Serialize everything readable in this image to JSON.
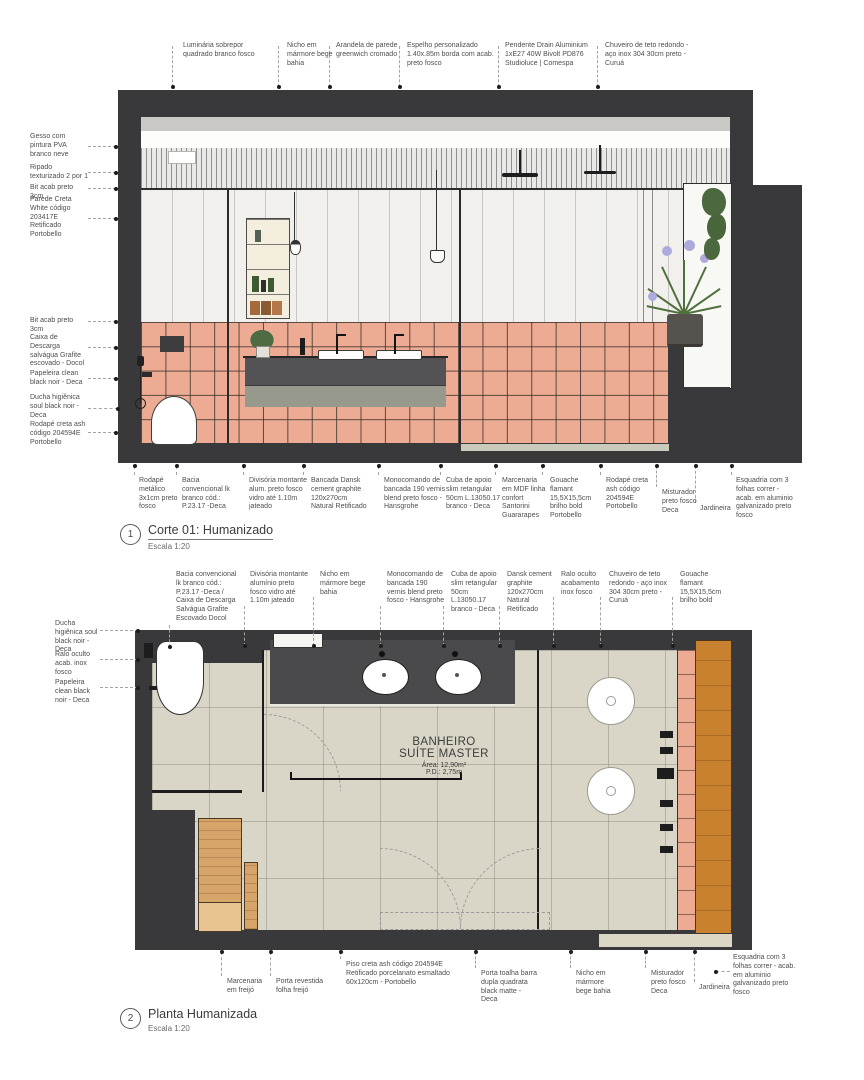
{
  "corte": {
    "index": "1",
    "title": "Corte 01: Humanizado",
    "scale": "Escala 1:20",
    "annotations_top": [
      "Luminária sobrepor quadrado branco fosco",
      "Nicho em mármore bege bahia",
      "Arandela de parede greenwich cromado",
      "Espelho personalizado 1.40x.85m borda com acab. preto fosco",
      "Pendente Drain Aluminium 1xE27 40W Bivolt PD876 Studioluce | Comespa",
      "Chuveiro de teto redondo - aço inox 304 30cm preto - Curuá"
    ],
    "annotations_left": [
      "Gesso com pintura PVA branco neve",
      "Ripado texturizado 2 por 1",
      "Bit acab preto 3cm",
      "Parede Creta White código 203417E Retificado Portobello",
      "Bit acab preto 3cm",
      "Caixa de Descarga salvágua Grafite escovado - Docol",
      "Papeleira clean black noir - Deca",
      "Ducha higiênica soul black noir - Deca",
      "Rodapé creta ash código 204594E Portobello"
    ],
    "annotations_bottom": [
      "Rodapé metálico 3x1cm preto fosco",
      "Bacia convencional lk branco cód.: P.23.17 -Deca",
      "Divisória montante alum. preto fosco vidro até 1.10m jateado",
      "Bancada Dansk cement graphite 120x270cm Natural Retificado",
      "Monocomando de bancada 190 vernis blend preto fosco - Hansgrohe",
      "Cuba de apoio slim retangular 50cm L.13050.17 branco - Deca",
      "Marcenaria em MDF linha confort Santorini Guararapes",
      "Gouache flamant 15,5X15,5cm brilho bold Portobello",
      "Rodapé creta ash código 204594E Portobello",
      "Misturador preto fosco Deca",
      "Jardineira",
      "Esquadria com 3 folhas correr - acab. em aluminio galvanizado preto fosco"
    ]
  },
  "planta": {
    "index": "2",
    "title": "Planta Humanizada",
    "scale": "Escala 1:20",
    "annotations_top": [
      "Bacia convencional lk branco cód.: P.23.17 -Deca / Caixa de Descarga Salvágua Grafite Escovado Docol",
      "Divisória montante alumínio preto fosco vidro até 1.10m jateado",
      "Nicho em mármore bege bahia",
      "Monocomando de bancada 190 vernis blend preto fosco - Hansgrohe",
      "Cuba de apoio slim retangular 50cm L.13050.17 branco - Deca",
      "Dansk cement graphite 120x270cm Natural Retificado",
      "Ralo oculto acabamento inox fosco",
      "Chuveiro de teto redondo - aço inox 304 30cm preto - Curuá",
      "Gouache flamant 15,5X15,5cm brilho bold"
    ],
    "annotations_left": [
      "Ducha higiênica soul black noir - Deca",
      "Ralo oculto acab. inox fosco",
      "Papeleira clean black noir - Deca"
    ],
    "annotations_bottom": [
      "Marcenaria em freijó",
      "Porta revestida folha freijó",
      "Piso creta ash código 204594E Retificado porcelanato esmaltado 60x120cm - Portobello",
      "Porta toalha barra dupla quadrata black matte - Deca",
      "Nicho em mármore bege bahia",
      "Misturador preto fosco Deca",
      "Jardineira",
      "Esquadria com 3 folhas correr - acab. em aluminio galvanizado preto fosco"
    ],
    "room": {
      "name_line1": "BANHEIRO",
      "name_line2": "SUÍTE MASTER",
      "area": "Área: 12,90m²",
      "ceiling_height": "P.D.: 2,75m"
    }
  },
  "colors": {
    "wall_dark": "#39393b",
    "tile_pink": "#ecab92",
    "floor_beige": "#d9d6c7",
    "wood_freijo": "#d7a469",
    "planter_orange": "#c8812f",
    "mirror_gray": "#a8a8a8"
  }
}
